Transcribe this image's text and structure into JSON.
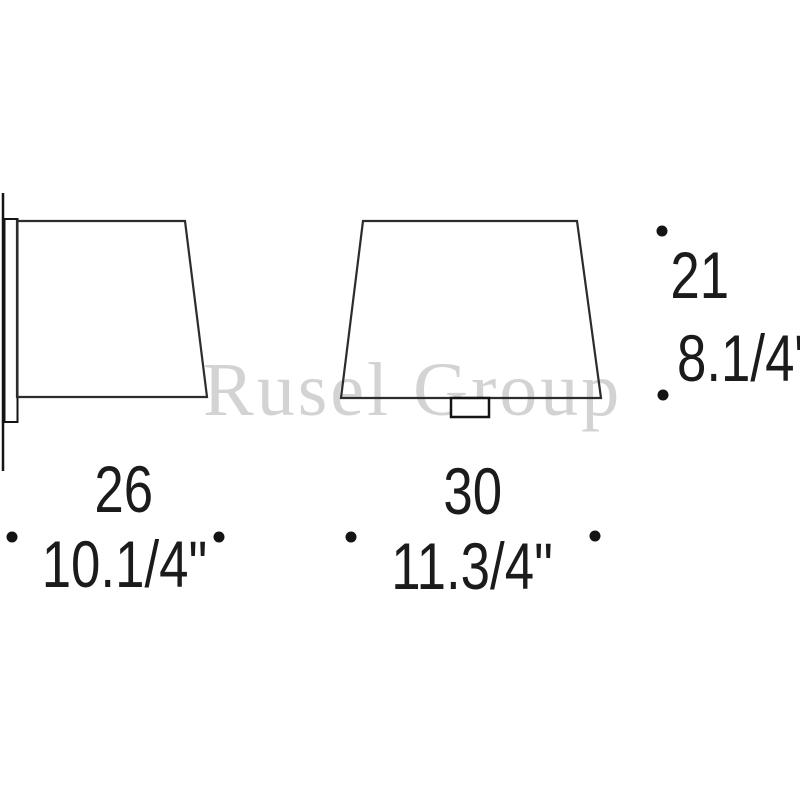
{
  "watermark": {
    "text": "Rusel Group"
  },
  "drawing": {
    "type": "lamp-dimension-diagram",
    "views": [
      "side-view",
      "front-view"
    ],
    "dimensions": {
      "side_depth": {
        "cm": "26",
        "inch": "10.1/4\""
      },
      "front_width": {
        "cm": "30",
        "inch": "11.3/4\""
      },
      "height": {
        "cm": "21",
        "inch": "8.1/4\""
      }
    }
  },
  "colors": {
    "background": "#ffffff",
    "outline": "#2c2c2c",
    "dark_outline": "#141414",
    "dimension_text": "#1b1b1b",
    "watermark": "#d3d3d3"
  }
}
